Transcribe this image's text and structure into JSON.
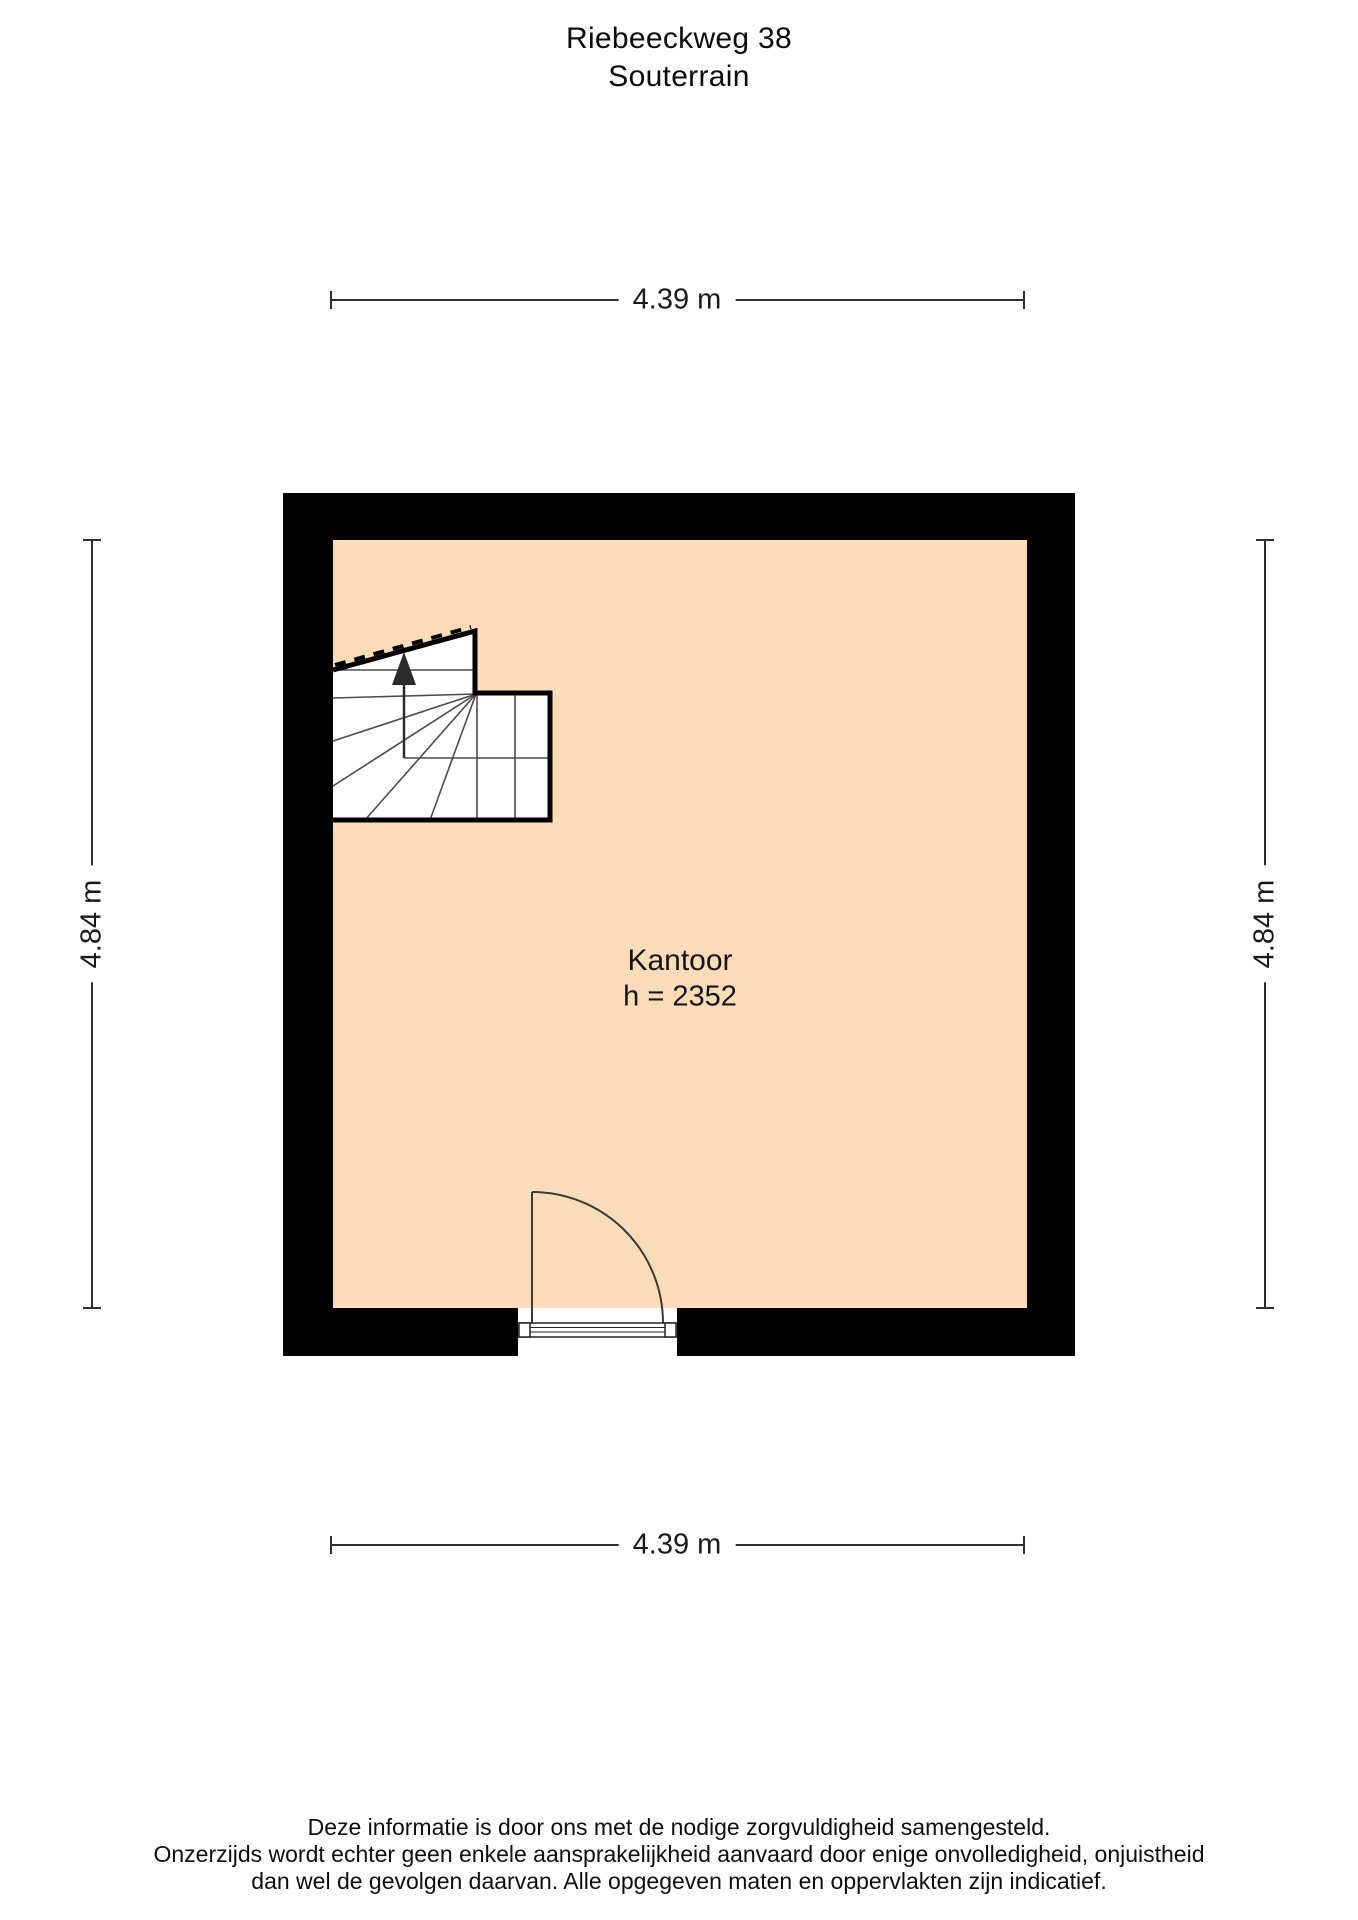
{
  "page": {
    "title_line1": "Riebeeckweg 38",
    "title_line2": "Souterrain"
  },
  "floorplan": {
    "room": {
      "name": "Kantoor",
      "height_label": "h = 2352"
    },
    "dimensions": {
      "top": "4.39 m",
      "bottom": "4.39 m",
      "left": "4.84 m",
      "right": "4.84 m"
    },
    "colors": {
      "room_fill": "#FBDCB8",
      "wall": "#000000",
      "dimension_line": "#2e2e2e",
      "stair_line": "#4c4c4c"
    },
    "icons": {
      "stairs_arrow": "up-arrow"
    }
  },
  "disclaimer": {
    "lines": [
      "Deze informatie is door ons met de nodige zorgvuldigheid samengesteld.",
      "Onzerzijds wordt echter geen enkele aansprakelijkheid aanvaard door enige onvolledigheid, onjuistheid",
      "dan wel de gevolgen daarvan. Alle opgegeven maten en oppervlakten zijn indicatief."
    ]
  }
}
